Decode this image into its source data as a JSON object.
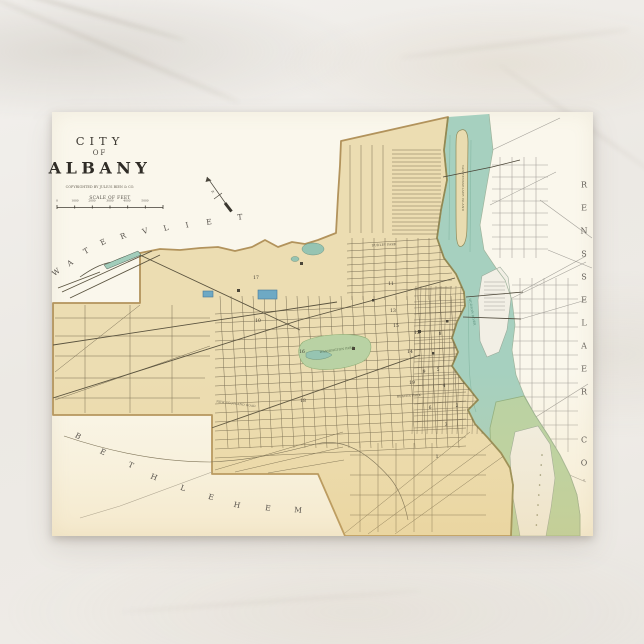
{
  "postcard": {
    "title_line1": "CITY",
    "title_line2": "OF",
    "title_line3": "ALBANY",
    "imprint": "COPYRIGHTED BY JULIUS BIEN & CO.",
    "scale_label": "SCALE OF FEET",
    "scale_ticks": [
      "0",
      "1000",
      "2000",
      "3000",
      "4000",
      "5000"
    ],
    "compass_letter": "N"
  },
  "regions": {
    "watervliet": {
      "text": "WATERVLIET",
      "letters": [
        {
          "ch": "W",
          "x": 56,
          "y": 272,
          "r": -38
        },
        {
          "ch": "A",
          "x": 70,
          "y": 263,
          "r": -34
        },
        {
          "ch": "T",
          "x": 86,
          "y": 251,
          "r": -30
        },
        {
          "ch": "E",
          "x": 103,
          "y": 242,
          "r": -26
        },
        {
          "ch": "R",
          "x": 123,
          "y": 236,
          "r": -22
        },
        {
          "ch": "V",
          "x": 145,
          "y": 231,
          "r": -18
        },
        {
          "ch": "L",
          "x": 166,
          "y": 228,
          "r": -15
        },
        {
          "ch": "I",
          "x": 187,
          "y": 225,
          "r": -12
        },
        {
          "ch": "E",
          "x": 209,
          "y": 222,
          "r": -9
        },
        {
          "ch": "T",
          "x": 240,
          "y": 217,
          "r": -6
        }
      ]
    },
    "bethlehem": {
      "text": "BETHLEHEM",
      "letters": [
        {
          "ch": "B",
          "x": 78,
          "y": 436,
          "r": 30
        },
        {
          "ch": "E",
          "x": 103,
          "y": 452,
          "r": 28
        },
        {
          "ch": "T",
          "x": 131,
          "y": 465,
          "r": 25
        },
        {
          "ch": "H",
          "x": 154,
          "y": 477,
          "r": 22
        },
        {
          "ch": "L",
          "x": 183,
          "y": 488,
          "r": 18
        },
        {
          "ch": "E",
          "x": 211,
          "y": 497,
          "r": 15
        },
        {
          "ch": "H",
          "x": 237,
          "y": 505,
          "r": 12
        },
        {
          "ch": "E",
          "x": 268,
          "y": 508,
          "r": 8
        },
        {
          "ch": "M",
          "x": 298,
          "y": 510,
          "r": 5
        }
      ]
    },
    "rensselaer": {
      "text": "RENSSELAER CO.",
      "letters": [
        {
          "ch": "R",
          "x": 584,
          "y": 185,
          "r": 0
        },
        {
          "ch": "E",
          "x": 584,
          "y": 208,
          "r": 0
        },
        {
          "ch": "N",
          "x": 584,
          "y": 231,
          "r": 0
        },
        {
          "ch": "S",
          "x": 584,
          "y": 254,
          "r": 0
        },
        {
          "ch": "S",
          "x": 584,
          "y": 277,
          "r": 0
        },
        {
          "ch": "E",
          "x": 584,
          "y": 300,
          "r": 0
        },
        {
          "ch": "L",
          "x": 584,
          "y": 323,
          "r": 0
        },
        {
          "ch": "A",
          "x": 584,
          "y": 346,
          "r": 0
        },
        {
          "ch": "E",
          "x": 584,
          "y": 369,
          "r": 0
        },
        {
          "ch": "R",
          "x": 584,
          "y": 392,
          "r": 0
        },
        {
          "ch": "C",
          "x": 584,
          "y": 440,
          "r": 0
        },
        {
          "ch": "O",
          "x": 584,
          "y": 463,
          "r": 0
        },
        {
          "ch": ".",
          "x": 584,
          "y": 478,
          "r": 0
        }
      ]
    }
  },
  "map": {
    "ward_numbers": [
      {
        "n": "17",
        "x": 256,
        "y": 278
      },
      {
        "n": "10",
        "x": 258,
        "y": 321
      },
      {
        "n": "16",
        "x": 302,
        "y": 352
      },
      {
        "n": "18",
        "x": 303,
        "y": 401
      },
      {
        "n": "11",
        "x": 391,
        "y": 284
      },
      {
        "n": "13",
        "x": 393,
        "y": 311
      },
      {
        "n": "15",
        "x": 396,
        "y": 326
      },
      {
        "n": "12",
        "x": 417,
        "y": 333
      },
      {
        "n": "14",
        "x": 410,
        "y": 352
      },
      {
        "n": "19",
        "x": 412,
        "y": 383
      },
      {
        "n": "9",
        "x": 424,
        "y": 372
      },
      {
        "n": "8",
        "x": 440,
        "y": 334
      },
      {
        "n": "5",
        "x": 438,
        "y": 370
      },
      {
        "n": "4",
        "x": 444,
        "y": 386
      },
      {
        "n": "6",
        "x": 430,
        "y": 408
      },
      {
        "n": "2",
        "x": 457,
        "y": 406
      },
      {
        "n": "3",
        "x": 446,
        "y": 425
      },
      {
        "n": "1",
        "x": 437,
        "y": 457
      }
    ],
    "labels": [
      {
        "text": "DUDLEY PARK",
        "x": 384,
        "y": 245,
        "r": -3,
        "color": "#57503f"
      },
      {
        "text": "WASHINGTON PARK",
        "x": 337,
        "y": 350,
        "r": -8,
        "color": "#4f6444"
      },
      {
        "text": "BEAVER PARK",
        "x": 409,
        "y": 396,
        "r": -4,
        "color": "#57503f"
      },
      {
        "text": "NEW SCOTLAND ROAD",
        "x": 236,
        "y": 404,
        "r": 7,
        "color": "#6a6350"
      },
      {
        "text": "VAN RENSSELAER ISLAND",
        "x": 463,
        "y": 188,
        "r": 90,
        "color": "#6b6649"
      },
      {
        "text": "HUDSON RIVER",
        "x": 472,
        "y": 312,
        "r": 80,
        "color": "#4f8571"
      }
    ],
    "colors": {
      "card": "#faf7ec",
      "city_fill": "#ecddb2",
      "city_boundary": "#b2935c",
      "river": "#a6d0bf",
      "island_green": "#b9d3a5",
      "park_green": "#b9d2a4",
      "reservoir_blue": "#6ea9c4",
      "marble_background": "#ece9e4"
    }
  }
}
